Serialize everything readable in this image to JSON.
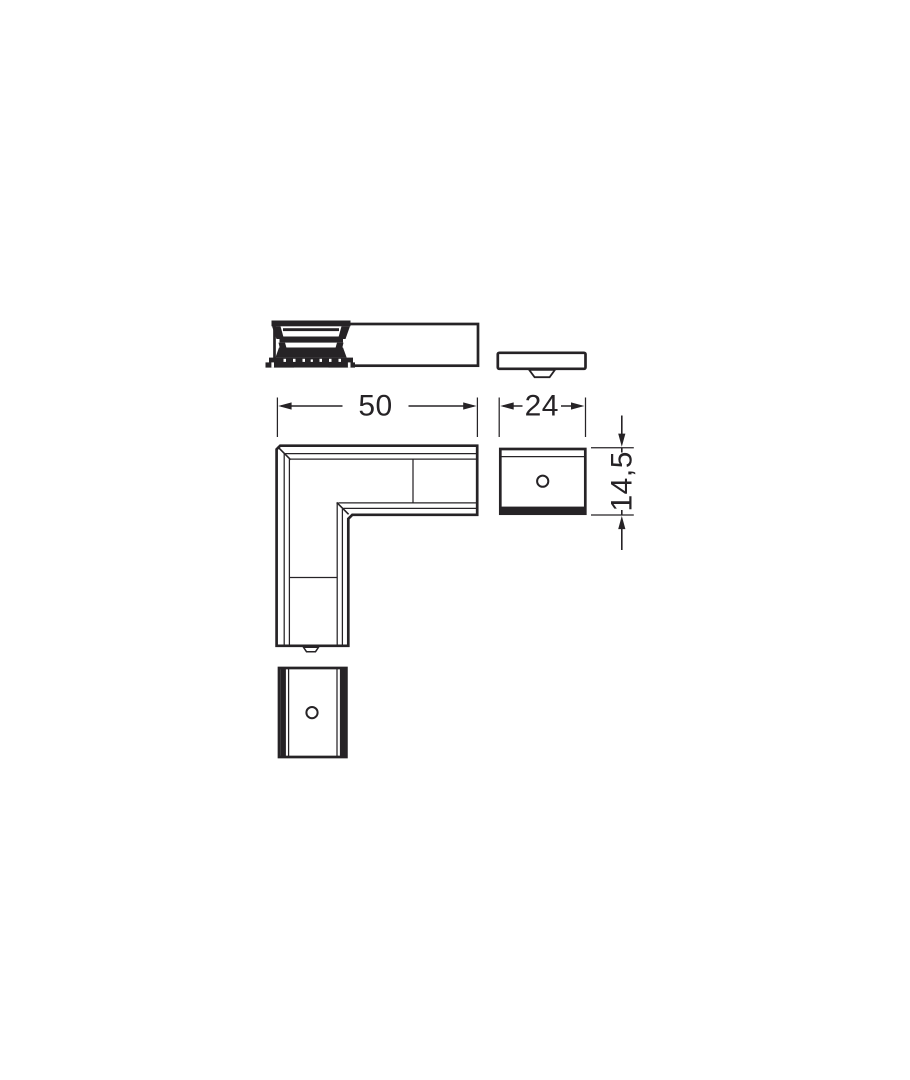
{
  "canvas": {
    "background_color": "#ffffff",
    "line_color": "#262326"
  },
  "drawing": {
    "dimensions": {
      "width": {
        "value": "50"
      },
      "depth": {
        "value": "24"
      },
      "height": {
        "value": "14,5"
      }
    }
  }
}
